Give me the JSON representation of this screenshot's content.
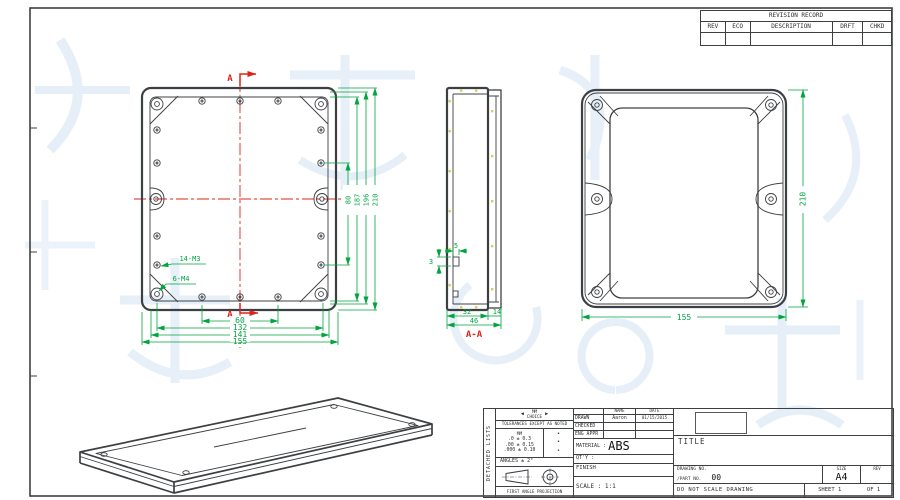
{
  "drawing": {
    "revision_table": {
      "title": "REVISION RECORD",
      "columns": [
        "REV",
        "ECO",
        "DESCRIPTION",
        "DRFT",
        "CHKD"
      ]
    },
    "front_view": {
      "section_marker": "A",
      "bottom_dims": [
        "60",
        "132",
        "141",
        "155"
      ],
      "side_dims": [
        "80",
        "187",
        "196",
        "210"
      ],
      "thread_labels": [
        "14-M3",
        "6-M4"
      ]
    },
    "section_view": {
      "label": "A-A",
      "lip_width": "5",
      "lip_height": "3",
      "body_depth": "32",
      "lid_depth": "14",
      "total_depth": "46"
    },
    "back_view": {
      "height": "210",
      "width": "155"
    },
    "title_block": {
      "side_label": "DETACHED LISTS",
      "units_primary": "MM",
      "units_secondary": "CHOICE",
      "arrow_left": "◀",
      "arrow_right": "▶",
      "tolerance_note": "TOLERANCES EXCEPT AS NOTED",
      "tol_col_header": "MM",
      "tolerances": [
        {
          "range": ".0 ± 0.3",
          "flag": "•"
        },
        {
          "range": ".00 ± 0.15",
          "flag": "•"
        },
        {
          "range": ".000 ± 0.10",
          "flag": "•"
        }
      ],
      "angles_note": "ANGLES ± 2°",
      "projection_caption": "FIRST ANGLE PROJECTION",
      "approval_headers": {
        "name": "NAME",
        "date": "DATE"
      },
      "approvals": [
        {
          "role": "DRAWN",
          "name": "Aaron",
          "date": "01/15/2015"
        },
        {
          "role": "CHECKED",
          "name": "",
          "date": ""
        },
        {
          "role": "ENG APPR",
          "name": "",
          "date": ""
        }
      ],
      "material_label": "MATERIAL :",
      "material_value": "ABS",
      "qty_label": "QT'Y :",
      "finish_label": "FINISH",
      "scale_label": "SCALE :",
      "scale_value": "1:1",
      "title_label": "TITLE",
      "drawing_no_label": "DRAWING NO.",
      "part_no_label": "/PART NO.",
      "part_no_value": "00",
      "size_label": "SIZE",
      "size_value": "A4",
      "rev_label": "REV",
      "do_not_scale": "DO NOT SCALE DRAWING",
      "sheet_label": "SHEET 1",
      "sheet_of": "OF 1"
    },
    "colors": {
      "dimension": "#00a53e",
      "centerline": "#e02318",
      "outline": "#3d4043",
      "watermark": "#cfe0f2",
      "hatch_speck": "#d8ce52"
    }
  }
}
